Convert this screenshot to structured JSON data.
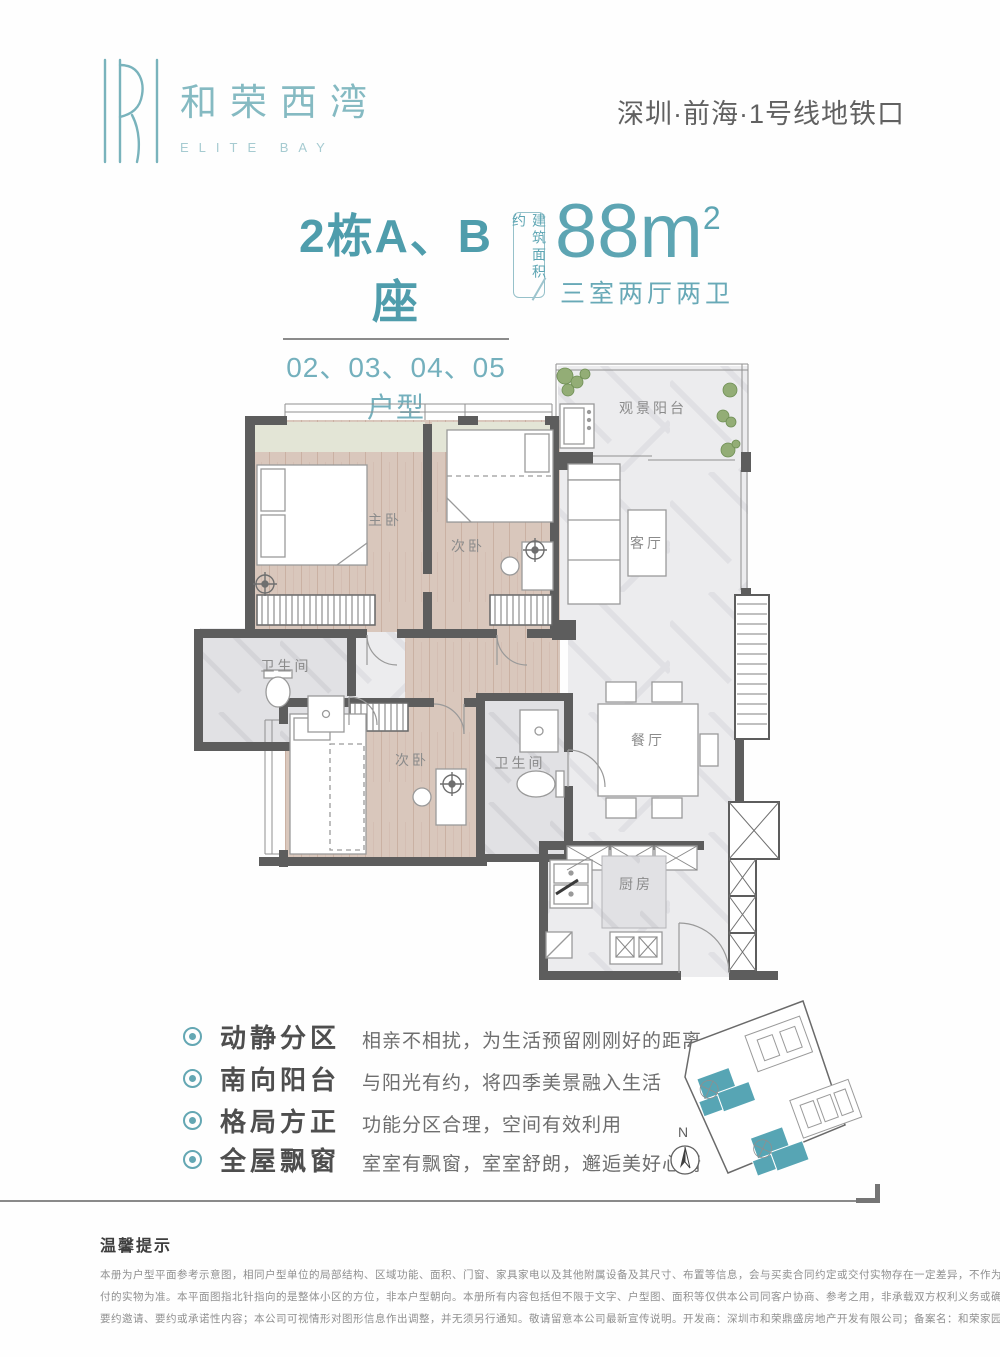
{
  "brand": {
    "name_cn": "和荣西湾",
    "name_en": "ELITE BAY"
  },
  "header": {
    "location": "深圳·前海·1号线地铁口"
  },
  "unit": {
    "building": "2栋A、B座",
    "units_line": "02、03、04、05户型",
    "area_label": "建筑面积约",
    "area_number": "88m",
    "area_sup": "2",
    "layout": "三室两厅两卫"
  },
  "floorplan": {
    "rooms": [
      {
        "label": "主卧"
      },
      {
        "label": "次卧"
      },
      {
        "label": "观景阳台"
      },
      {
        "label": "客厅"
      },
      {
        "label": "卫生间"
      },
      {
        "label": "次卧"
      },
      {
        "label": "卫生间"
      },
      {
        "label": "餐厅"
      },
      {
        "label": "厨房"
      }
    ]
  },
  "features": [
    {
      "label": "动静分区",
      "desc": "相亲不相扰，为生活预留刚刚好的距离"
    },
    {
      "label": "南向阳台",
      "desc": "与阳光有约，将四季美景融入生活"
    },
    {
      "label": "格局方正",
      "desc": "功能分区合理，空间有效利用"
    },
    {
      "label": "全屋飘窗",
      "desc": "室室有飘窗，室室舒朗，邂逅美好心情"
    }
  ],
  "siteplan": {
    "north_label": "N"
  },
  "disclaimer": {
    "title": "温馨提示",
    "lines": [
      "本册为户型平面参考示意图，相同户型单位的局部结构、区域功能、面积、门窗、家具家电以及其他附属设备及其尺寸、布置等信息，会与买卖合同约定或交付实物存在一定差异，不作为交楼标准，最终以双方签署的房屋买卖合同以及交",
      "付的实物为准。本平面图指北针指向的是整体小区的方位，非本户型朝向。本册所有内容包括但不限于文字、户型图、面积等仅供本公司同客户协商、参考之用，非承载双方权利义务或确定性意思表达的法律文书，亦不包括本公司的任何",
      "要约邀请、要约或承诺性内容；本公司可视情形对图形信息作出调整，并无须另行通知。敬请留意本公司最新宣传说明。开发商：深圳市和荣鼎盛房地产开发有限公司；备案名：和荣家园；推广名：和荣西湾；制作时间：2023年4月"
    ]
  },
  "colors": {
    "accent": "#5da5b3",
    "wall": "#5d5d5d"
  }
}
